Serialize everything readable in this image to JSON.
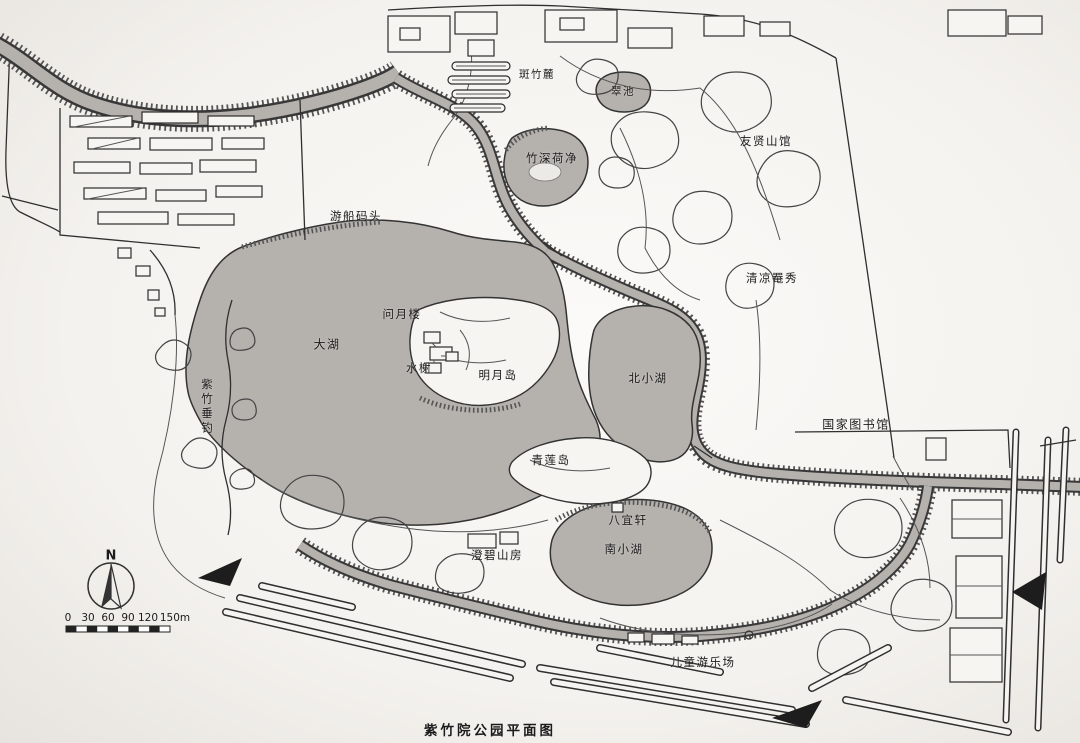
{
  "title": "紫竹院公园平面图",
  "compass": {
    "north_label": "N"
  },
  "scale_bar": {
    "ticks": [
      "0",
      "30",
      "60",
      "90",
      "120",
      "150m"
    ]
  },
  "labels": {
    "banzhulu": "斑竹麓",
    "cuichi": "翠池",
    "zhushenhejing": "竹深荷净",
    "youxianshanguan": "友贤山馆",
    "youchuanmatou": "游船码头",
    "qingliangyanxiu": "清凉罨秀",
    "wenyuelou": "问月楼",
    "dahu": "大湖",
    "shuixie": "水榭",
    "mingyuedao": "明月岛",
    "beixiaohu": "北小湖",
    "zizhuchuidiao": "紫竹垂钓",
    "guojiatushuguan": "国家图书馆",
    "qingliandao": "青莲岛",
    "bayixuan": "八宜轩",
    "nanxiaohu": "南小湖",
    "chengbishanfang": "澄碧山房",
    "ertongyoulechang": "儿童游乐场"
  },
  "colors": {
    "paper": "#f4f2ee",
    "ink": "#2f2f2f",
    "water": "#b5b2ae",
    "road_fill": "#f6f4f1",
    "label": "#1c1c1c"
  }
}
